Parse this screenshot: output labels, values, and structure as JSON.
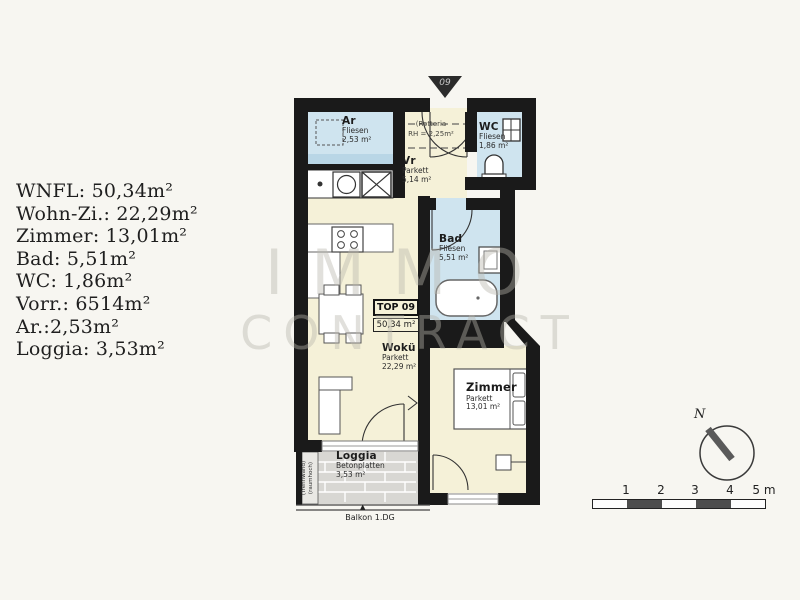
{
  "info_panel": {
    "lines": [
      "WNFL: 50,34m²",
      "Wohn-Zi.: 22,29m²",
      "Zimmer: 13,01m²",
      "Bad: 5,51m²",
      "WC: 1,86m²",
      "Vorr.: 6514m²",
      "Ar.:2,53m²",
      "Loggia: 3,53m²"
    ]
  },
  "watermark": {
    "line1": "IMMO",
    "line2": "CONTRACT"
  },
  "entrance_marker": {
    "label": "09"
  },
  "unit_box": {
    "label": "TOP 09",
    "area": "50,34 m²"
  },
  "rooms": {
    "ar": {
      "name": "Ar",
      "floor": "Fliesen",
      "area": "2,53 m²"
    },
    "vr": {
      "name": "Vr",
      "floor": "Parkett",
      "area": "5,14 m²"
    },
    "wc": {
      "name": "WC",
      "floor": "Fliesen",
      "area": "1,86 m²"
    },
    "bad": {
      "name": "Bad",
      "floor": "Fliesen",
      "area": "5,51 m²"
    },
    "woku": {
      "name": "Wokü",
      "floor": "Parkett",
      "area": "22,29 m²"
    },
    "zimmer": {
      "name": "Zimmer",
      "floor": "Parkett",
      "area": "13,01 m²"
    },
    "loggia": {
      "name": "Loggia",
      "floor": "Betonplatten",
      "area": "3,53 m²"
    }
  },
  "annotations": {
    "entrance_note_line1": "(Rotteria",
    "entrance_note_line2": "RH = 2,25m²",
    "partition_note_line1": "(Trennwand)",
    "partition_note_line2": "(raumhoch)",
    "balcony_label": "Balkon 1.DG",
    "balcony_arrow": "▲"
  },
  "compass": {
    "label": "N"
  },
  "scale_bar": {
    "labels": [
      "1",
      "2",
      "3",
      "4",
      "5 m"
    ]
  },
  "colors": {
    "wall": "#1a1a1a",
    "parkett": "#f5f1d8",
    "fliesen": "#cfe4ef",
    "loggia_floor": "#d8d7d3",
    "background": "#f7f6f1"
  }
}
